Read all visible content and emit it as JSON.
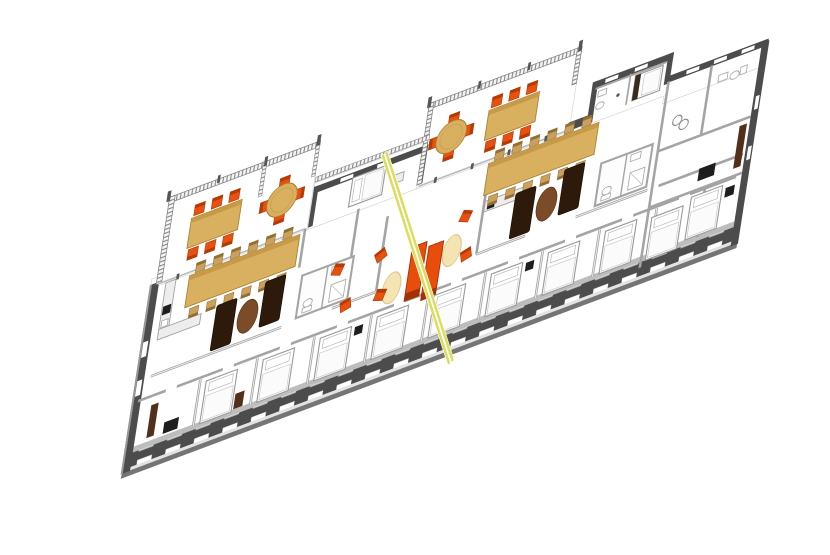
{
  "meta": {
    "title": "3D apartment floor plan render",
    "view": "axonometric floor plan, rotated diagonally, white background"
  },
  "colors": {
    "bg": "#ffffff",
    "wall-dark": "#4c4c4c",
    "wall-mid": "#a4a4a4",
    "wall-top": "#bdbdbd",
    "wall-base": "#757575",
    "slab-edge": "#e3e3e3",
    "floor": "#ffffff",
    "glass": "#b4bbc0",
    "chair-orange": "#e8500f",
    "chair-orange-dark": "#b53a05",
    "sofa-orange": "#e84d0c",
    "sofa-orange-dark": "#a23104",
    "chair-tan": "#caa05c",
    "chair-tan-dark": "#8f6f33",
    "table-tan": "#d9af60",
    "table-tan-dark": "#a8812f",
    "table-tan-edge": "#c79a48",
    "sofa-brown": "#2e1a0b",
    "rug-brown": "#7c4b27",
    "rug-cream": "#f3e4b2",
    "rug-cream-edge": "#dcc183",
    "wood-dark": "#54301b",
    "black-item": "#1e1e1e",
    "section-yellow": "#d9de5b",
    "bed-stroke": "#9a9a9a",
    "fixture-stroke": "#ababab",
    "rail-slat": "#8a8a8a",
    "rail-bg": "#f4f4f4"
  },
  "scene": {
    "building": {
      "apartments": 2,
      "balconies": 2,
      "section_line": "diagonal yellow-green double line crossing the plan"
    },
    "inventory": {
      "balcony_round_tables": 2,
      "chairs_per_round_table": 4,
      "balcony_dining_chairs_per_unit": 6,
      "balcony_tables_per_unit": 1,
      "indoor_dining_tables": 2,
      "chairs_per_dining_table": 12,
      "dark_brown_sofas": 4,
      "brown_oval_rugs": 2,
      "cream_oval_rugs": 2,
      "orange_lounge_sofas": 2,
      "orange_armchairs": 6,
      "beds": 12,
      "bathrooms": 4,
      "wardrobes": 3,
      "black_desks": 4
    }
  }
}
